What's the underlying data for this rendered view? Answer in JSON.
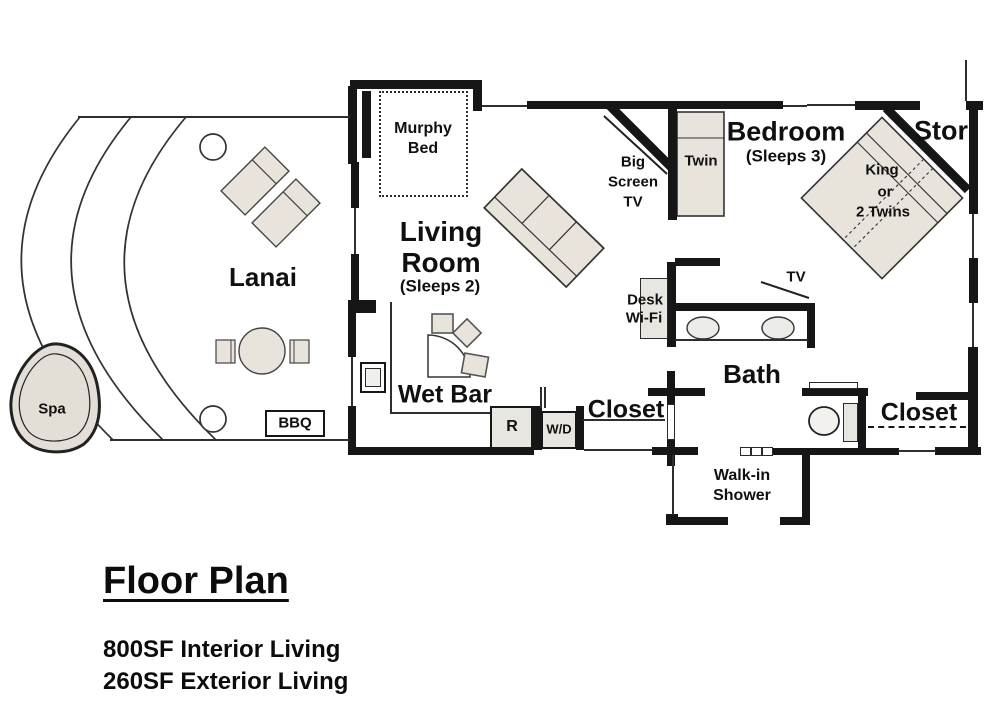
{
  "colors": {
    "wall": "#161616",
    "furniture_fill": "#e8e4db",
    "appliance_fill": "#e8e6e1",
    "line": "#333333",
    "background": "#ffffff"
  },
  "title_block": {
    "title": "Floor Plan",
    "interior_living": "800SF Interior Living",
    "exterior_living": "260SF Exterior Living"
  },
  "labels": {
    "lanai": "Lanai",
    "spa": "Spa",
    "bbq": "BBQ",
    "murphy_bed": {
      "line1": "Murphy",
      "line2": "Bed"
    },
    "living_room": {
      "line1": "Living",
      "line2": "Room",
      "sleeps": "(Sleeps 2)"
    },
    "wet_bar": "Wet Bar",
    "big_screen_tv": {
      "line1": "Big",
      "line2": "Screen",
      "line3": "TV"
    },
    "twin_bed": "Twin",
    "bedroom": {
      "name": "Bedroom",
      "sleeps": "(Sleeps 3)"
    },
    "storage": "Stor",
    "king_bed": {
      "line1": "King",
      "line2": "or",
      "line3": "2 Twins"
    },
    "desk": {
      "line1": "Desk",
      "line2": "Wi-Fi"
    },
    "bedroom_tv": "TV",
    "bath": "Bath",
    "hall_closet": "Closet",
    "bedroom_closet": "Closet",
    "walk_in_shower": {
      "line1": "Walk-in",
      "line2": "Shower"
    },
    "refrigerator": "R",
    "washer_dryer": "W/D"
  }
}
